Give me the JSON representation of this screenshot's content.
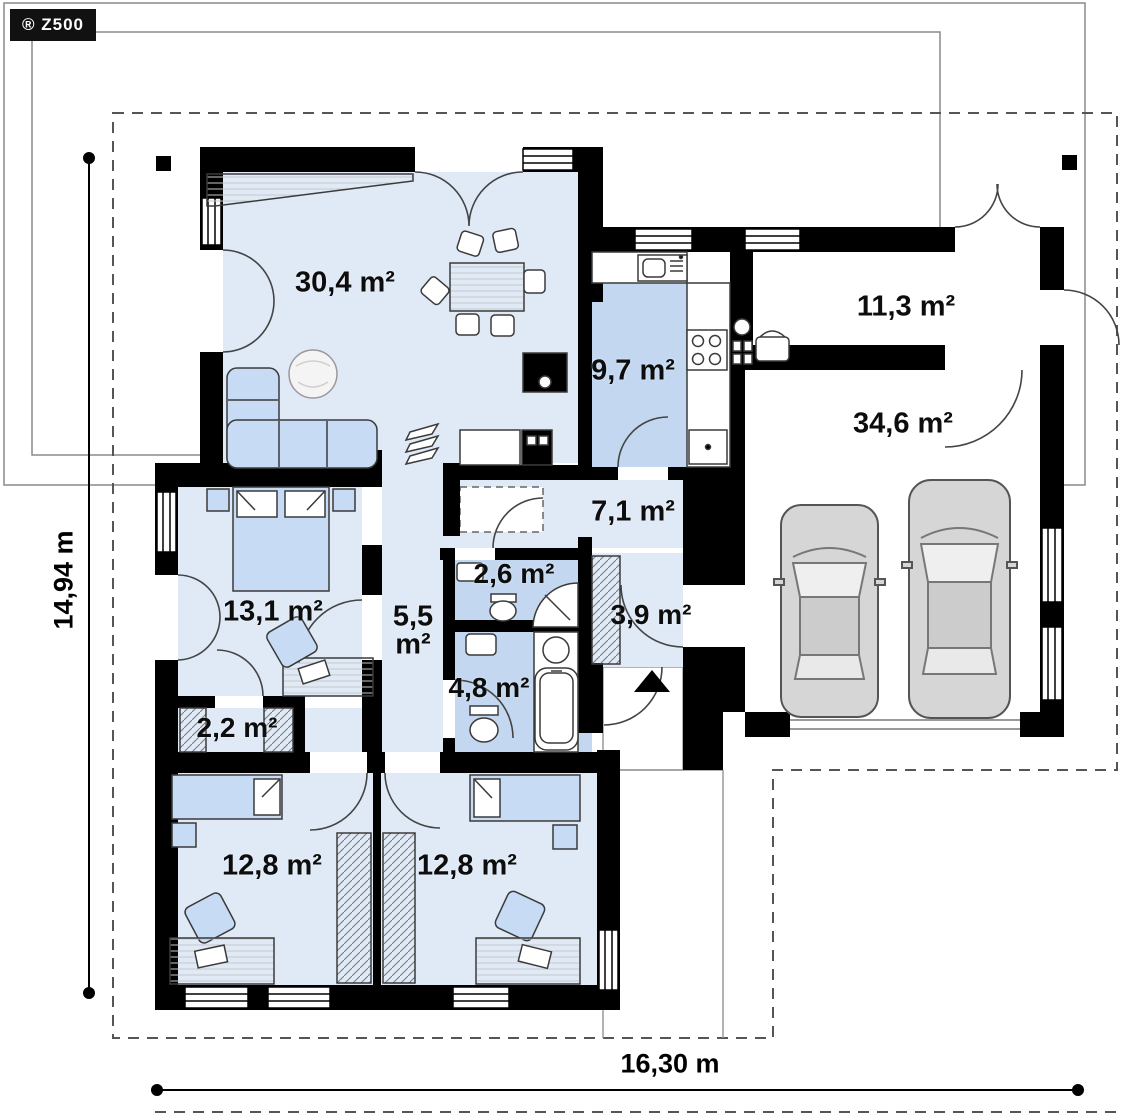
{
  "brand": {
    "logo": "® Z500"
  },
  "dimensions": {
    "width_label": "16,30 m",
    "height_label": "14,94 m"
  },
  "rooms": [
    {
      "id": "living-dining",
      "area": "30,4 m²"
    },
    {
      "id": "kitchen",
      "area": "9,7 m²"
    },
    {
      "id": "utility",
      "area": "11,3 m²"
    },
    {
      "id": "garage",
      "area": "34,6 m²"
    },
    {
      "id": "hall",
      "area": "7,1 m²"
    },
    {
      "id": "bedroom-1",
      "area": "13,1 m²"
    },
    {
      "id": "corridor",
      "area": "5,5 m²"
    },
    {
      "id": "wc",
      "area": "2,6 m²"
    },
    {
      "id": "entry",
      "area": "3,9 m²"
    },
    {
      "id": "bathroom",
      "area": "4,8 m²"
    },
    {
      "id": "wardrobe",
      "area": "2,2 m²"
    },
    {
      "id": "bedroom-2",
      "area": "12,8 m²"
    },
    {
      "id": "bedroom-3",
      "area": "12,8 m²"
    }
  ],
  "colors": {
    "wall": "#000000",
    "floor_light": "#e0eaf7",
    "floor_medium": "#c3d8f0",
    "furniture_blue": "#c7dcf4",
    "car_body": "#d6d6d6",
    "outline_dashed": "#555555"
  }
}
